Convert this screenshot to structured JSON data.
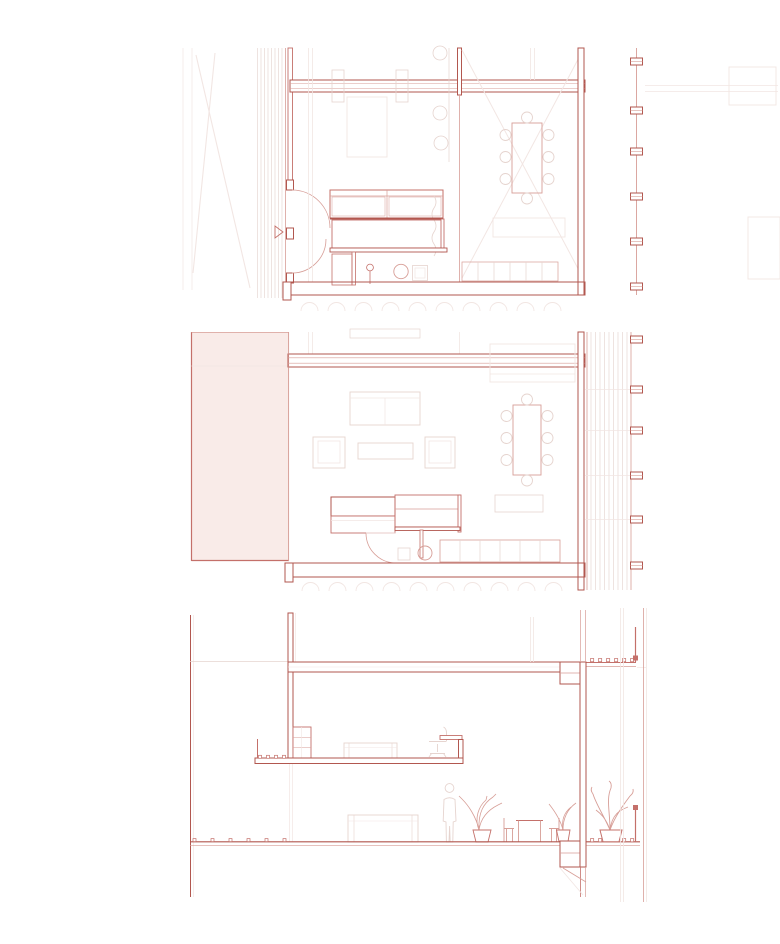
{
  "sheet": {
    "kind": "architectural-drawing-set",
    "text_visible": "",
    "panels": [
      {
        "name": "upper-floor-plan",
        "kind": "floor-plan"
      },
      {
        "name": "lower-floor-plan",
        "kind": "floor-plan"
      },
      {
        "name": "building-section",
        "kind": "section"
      }
    ]
  },
  "colors": {
    "paper": "#ffffff",
    "ink_strong": "#b2574f",
    "ink_medium": "#c4706a",
    "ink_light": "#d79e97",
    "ink_faint": "#e6d4cf",
    "ink_very_faint": "#f2e6e3",
    "pink_fill": "#f9ebe8",
    "hatch_line": "#e8d7d3",
    "crosshatch_line": "#e5c3bc",
    "stair_line": "#cf8d85"
  }
}
